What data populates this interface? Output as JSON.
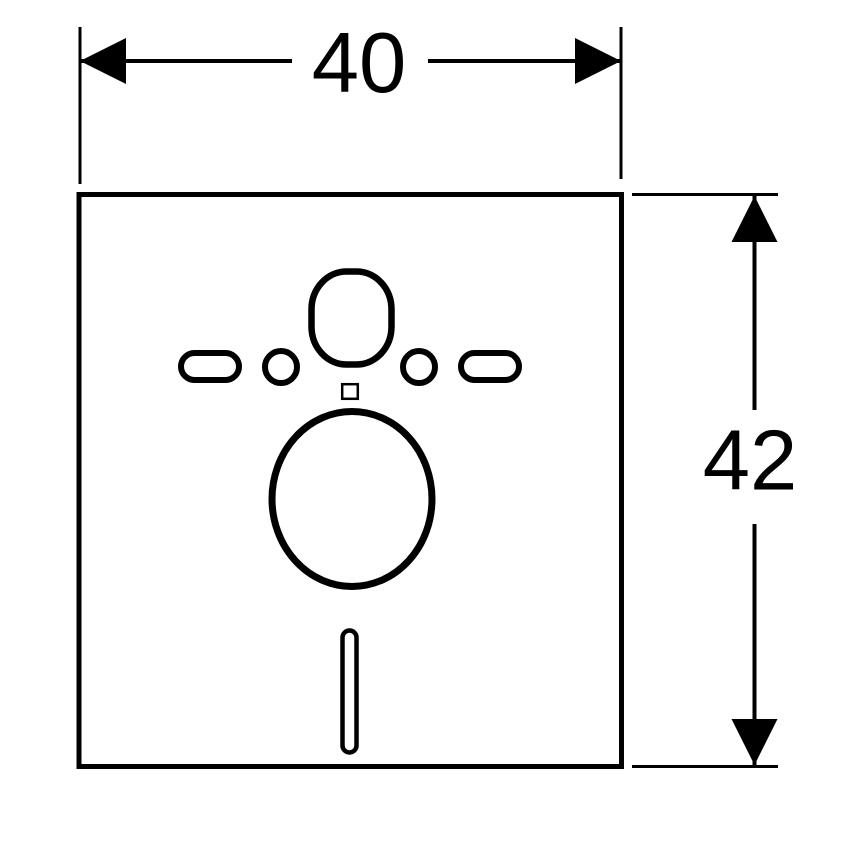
{
  "drawing": {
    "colors": {
      "line": "#000000",
      "background": "#ffffff"
    }
  },
  "dimensions": {
    "width": {
      "value": "40"
    },
    "height": {
      "value": "42"
    }
  }
}
